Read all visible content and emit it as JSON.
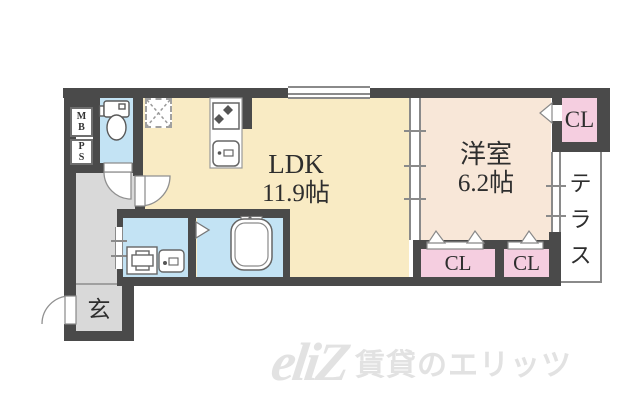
{
  "plan": {
    "rooms": {
      "ldk": {
        "label": "LDK",
        "area": "11.9帖"
      },
      "western_room": {
        "label": "洋室",
        "area": "6.2帖"
      },
      "terrace_chars": [
        "テ",
        "ラ",
        "ス"
      ],
      "entrance": "玄",
      "closets": [
        "CL",
        "CL",
        "CL"
      ],
      "meter_box": [
        "M",
        "B"
      ],
      "pipe_shaft": [
        "P",
        "S"
      ]
    },
    "colors": {
      "wall": "#4a4a4a",
      "ldk_floor": "#f9ebc4",
      "western_floor": "#f8e7d8",
      "closet": "#f5cee0",
      "wet_area": "#c3e3f4",
      "hall": "#d9d9d9",
      "watermark": "#e2e2e2"
    }
  },
  "watermark": {
    "logo": "eliZ",
    "text": "賃貸のエリッツ"
  }
}
